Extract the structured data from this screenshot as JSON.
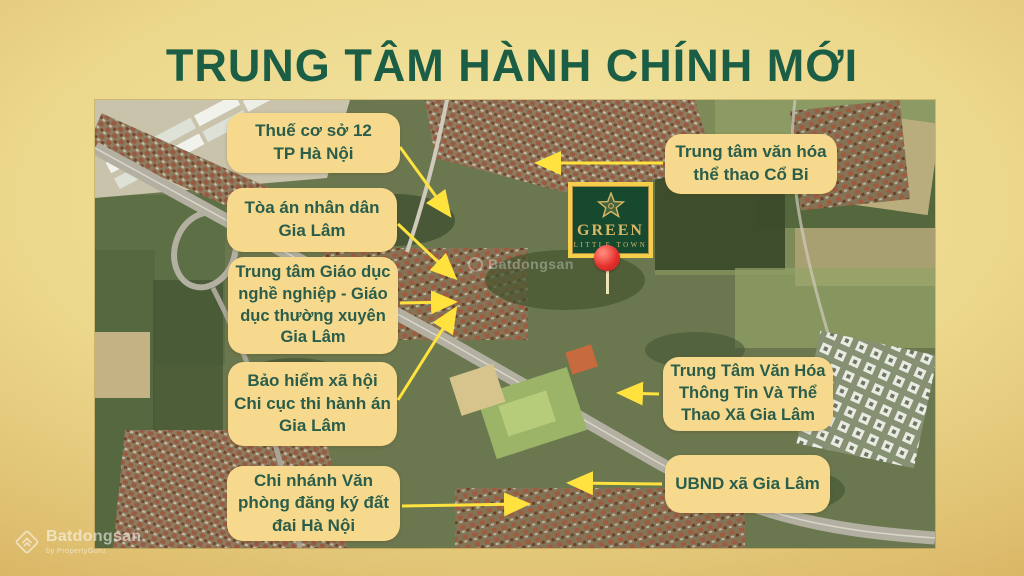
{
  "title": "TRUNG TÂM HÀNH CHÍNH MỚI",
  "colors": {
    "background_gold": "#e0c172",
    "title_green": "#1b5e45",
    "callout_bg": "#f6d98d",
    "callout_text": "#2a5d4b",
    "arrow_yellow": "#ffe23e",
    "logo_green": "#17492f",
    "logo_gold": "#d8b766",
    "logo_frame_yellow": "#f5cf4b",
    "pin_red": "#e5312e"
  },
  "project_logo": {
    "name_line1": "GREEN",
    "name_line2": "LITTLE TOWN"
  },
  "callouts": [
    {
      "id": "thue-co-so",
      "lines": [
        "Thuế cơ sở 12",
        "TP Hà Nội"
      ]
    },
    {
      "id": "toa-an",
      "lines": [
        "Tòa án nhân dân",
        "Gia Lâm"
      ]
    },
    {
      "id": "trung-tam-giao-duc",
      "lines": [
        "Trung tâm Giáo dục",
        "nghề nghiệp - Giáo",
        "dục thường xuyên",
        "Gia Lâm"
      ]
    },
    {
      "id": "bao-hiem",
      "lines": [
        "Bảo hiểm xã hội",
        "Chi cục thi hành án",
        "Gia Lâm"
      ]
    },
    {
      "id": "chi-nhanh",
      "lines": [
        "Chi nhánh Văn",
        "phòng đăng ký đất",
        "đai Hà Nội"
      ]
    },
    {
      "id": "co-bi",
      "lines": [
        "Trung tâm văn hóa",
        "thể thao Cổ Bi"
      ]
    },
    {
      "id": "van-hoa-thong-tin",
      "lines": [
        "Trung Tâm Văn Hóa",
        "Thông Tin Và Thể",
        "Thao Xã Gia Lâm"
      ]
    },
    {
      "id": "ubnd",
      "lines": [
        "UBND xã Gia Lâm"
      ]
    }
  ],
  "map_watermark": "Batdongsan",
  "brand_watermark": {
    "name": "Batdongsan",
    "byline": "by PropertyGuru"
  }
}
